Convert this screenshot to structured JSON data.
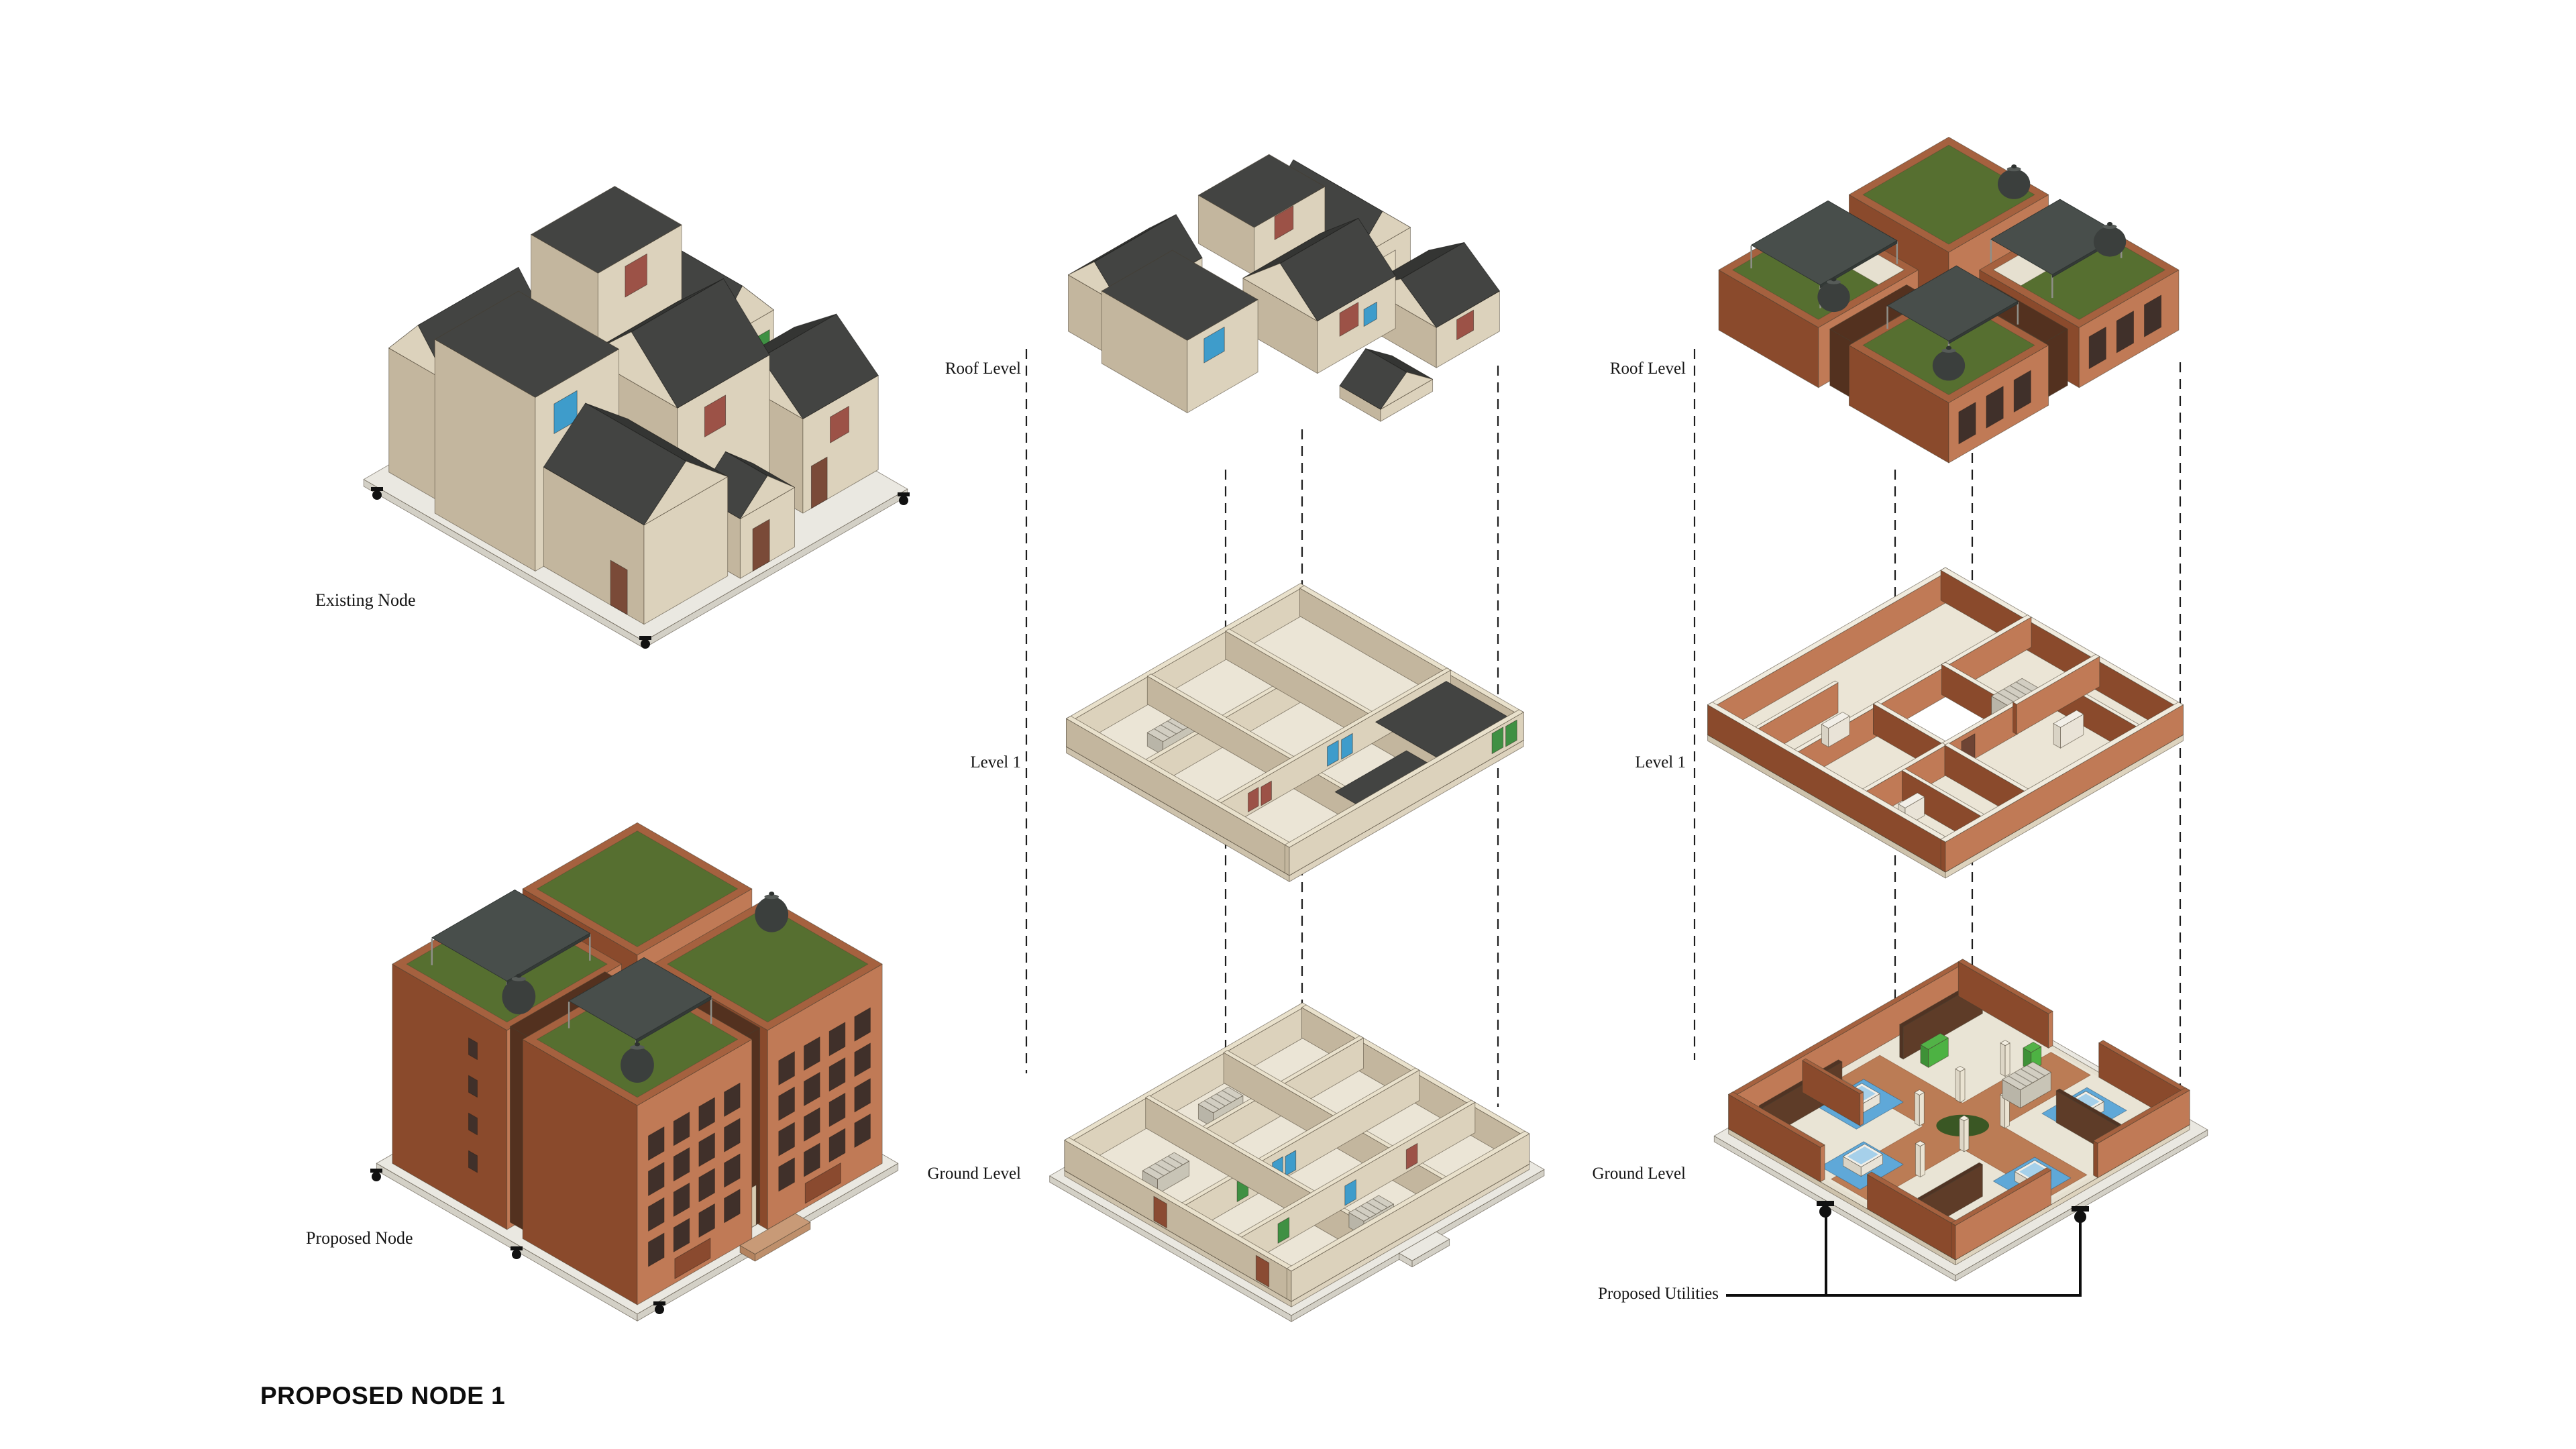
{
  "title": "PROPOSED NODE 1",
  "columns": {
    "left": {
      "top_label": "Existing Node",
      "bottom_label": "Proposed Node"
    },
    "middle": {
      "name": "existing-node-exploded-axon",
      "levels": [
        "Roof Level",
        "Level 1",
        "Ground Level"
      ]
    },
    "right": {
      "name": "proposed-node-exploded-axon",
      "levels": [
        "Roof Level",
        "Level 1",
        "Ground Level"
      ],
      "callout": "Proposed Utilities"
    }
  },
  "colors": {
    "wall_tan": "#DCD2BC",
    "wall_tan_shade": "#C3B69E",
    "roof_dark": "#434442",
    "brick_light": "#C07A56",
    "brick_shade": "#8A4A2C",
    "green_roof": "#566F30",
    "canopy_gray": "#484E4B",
    "pool_blue": "#5FA8D8",
    "path_brick": "#BB7C55",
    "window_blue": "#3E9CCB",
    "window_red": "#9C5247",
    "window_green": "#3F9043",
    "door_brown": "#7A4A38"
  }
}
